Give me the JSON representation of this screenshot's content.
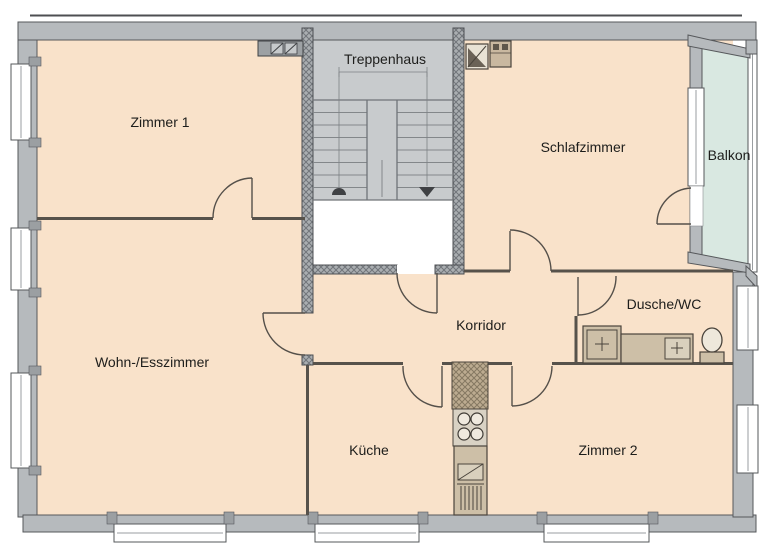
{
  "labels": {
    "zimmer1": "Zimmer 1",
    "treppenhaus": "Treppenhaus",
    "schlafzimmer": "Schlafzimmer",
    "balkon": "Balkon",
    "wohn_esszimmer": "Wohn-/Esszimmer",
    "korridor": "Korridor",
    "dusche_wc": "Dusche/WC",
    "kueche": "Küche",
    "zimmer2": "Zimmer 2"
  },
  "colors": {
    "floor": "#f9e2ca",
    "balcony": "#d9e8e1",
    "wall": "#b6babd",
    "wall_dark": "#56585b",
    "stair": "#c8cbcd",
    "landing": "#ffffff",
    "fixture": "#cdbfa7",
    "fixture_dark": "#4a443c",
    "chimney": "#b5a48c",
    "text": "#1d1d1b"
  }
}
